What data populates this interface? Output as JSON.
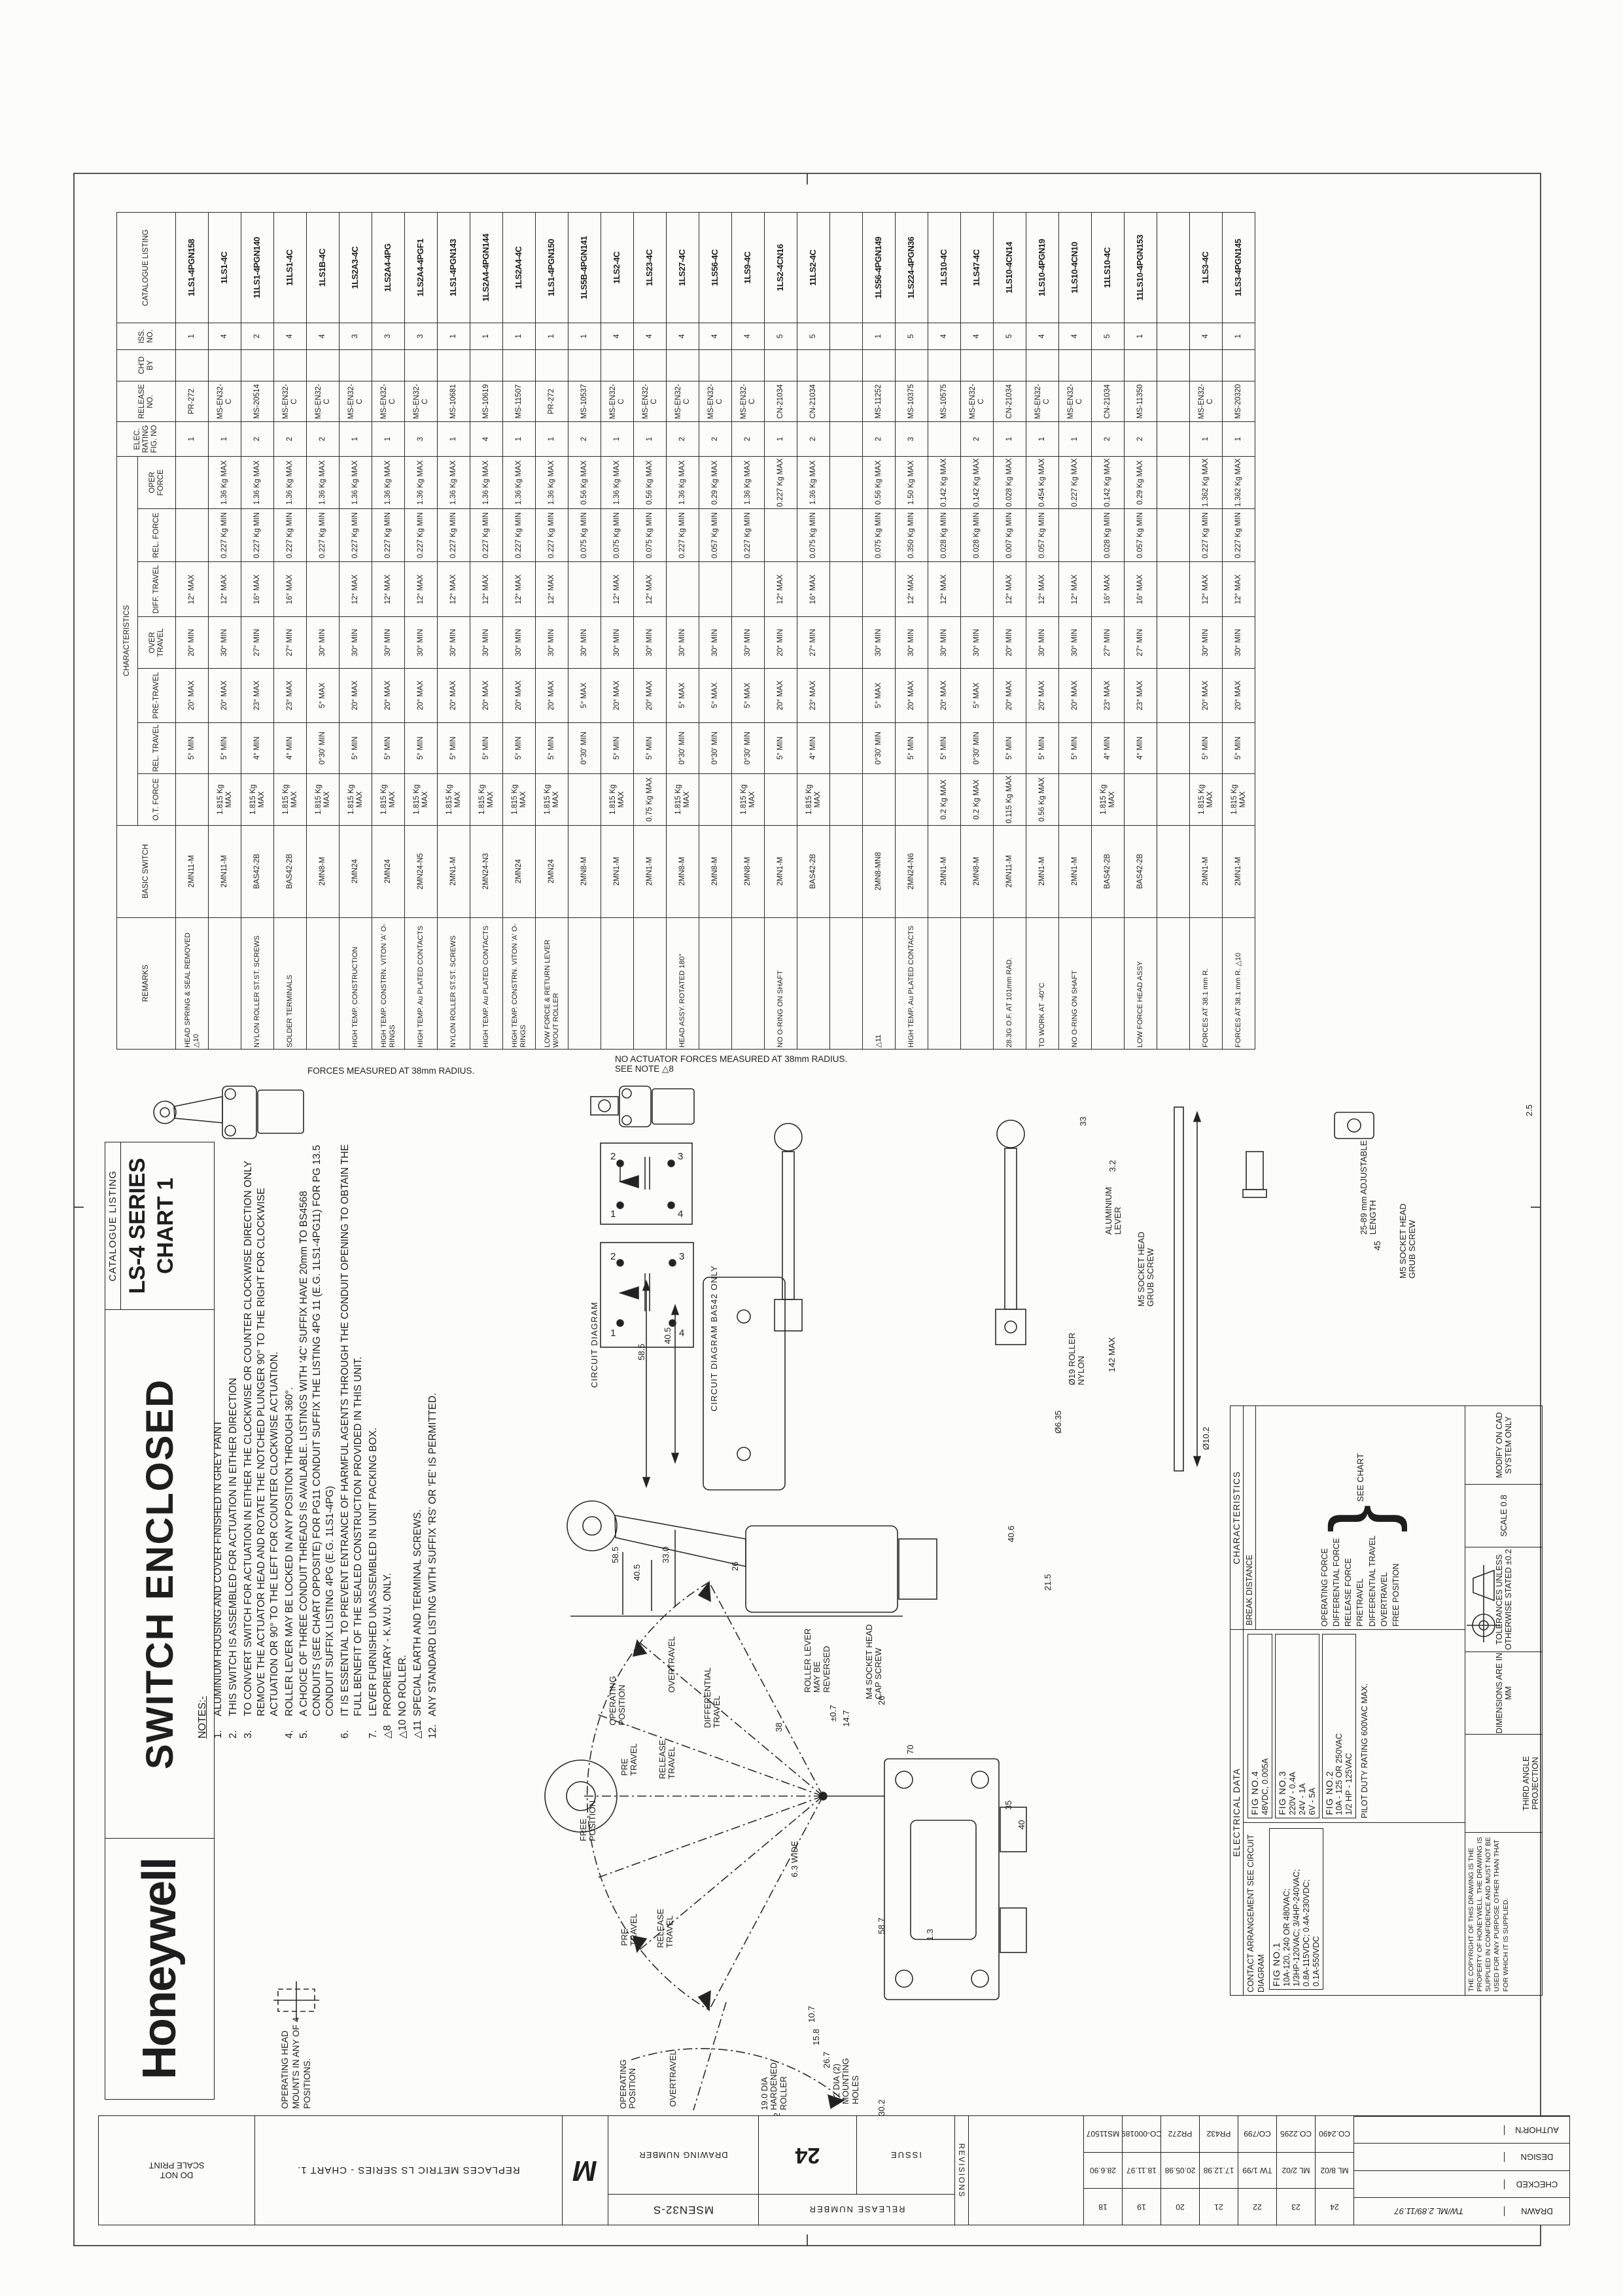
{
  "titleblock": {
    "brand": "Honeywell",
    "product": "SWITCH ENCLOSED",
    "listing_label": "CATALOGUE LISTING",
    "series": "LS-4 SERIES",
    "chart": "CHART 1",
    "head_note": "OPERATING HEAD MOUNTS IN ANY OF 4 POSITIONS."
  },
  "table": {
    "group": "CHARACTERISTICS",
    "headers": {
      "remarks": "REMARKS",
      "basic": "BASIC SWITCH",
      "otf": "O.T. FORCE",
      "relt": "REL. TRAVEL",
      "pre": "PRE-TRAVEL",
      "over": "OVER TRAVEL",
      "diff": "DIFF. TRAVEL",
      "relf": "REL. FORCE",
      "oper": "OPER FORCE",
      "elec": "ELEC. RATING FIG. NO",
      "release": "RELEASE NO.",
      "chd": "CH'D BY",
      "iss": "ISS. NO.",
      "cat": "CATALOGUE LISTING"
    },
    "rows": [
      {
        "rem": "HEAD SPRING & SEAL REMOVED △10",
        "basic": "2MN11-M",
        "otf": "",
        "relt": "5° MIN",
        "pre": "20° MAX",
        "over": "20° MIN",
        "diff": "12° MAX",
        "relf": "",
        "oper": "",
        "elec": "1",
        "rel": "PR-272",
        "chd": "",
        "iss": "1",
        "cat": "1LS1-4PGN158"
      },
      {
        "rem": "",
        "basic": "2MN11-M",
        "otf": "1.815 Kg MAX",
        "relt": "5° MIN",
        "pre": "20° MAX",
        "over": "30° MIN",
        "diff": "12° MAX",
        "relf": "0.227 Kg MIN",
        "oper": "1.36 Kg MAX",
        "elec": "1",
        "rel": "MS-EN32-C",
        "chd": "",
        "iss": "4",
        "cat": "1LS1-4C"
      },
      {
        "rem": "NYLON ROLLER ST.ST. SCREWS",
        "basic": "BAS42-2B",
        "otf": "1.815 Kg MAX",
        "relt": "4° MIN",
        "pre": "23° MAX",
        "over": "27° MIN",
        "diff": "16° MAX",
        "relf": "0.227 Kg MIN",
        "oper": "1.36 Kg MAX",
        "elec": "2",
        "rel": "MS-20514",
        "chd": "",
        "iss": "2",
        "cat": "11LS1-4PGN140"
      },
      {
        "rem": "SOLDER TERMINALS",
        "basic": "BAS42-2B",
        "otf": "1.815 Kg MAX",
        "relt": "4° MIN",
        "pre": "23° MAX",
        "over": "27° MIN",
        "diff": "16° MAX",
        "relf": "0.227 Kg MIN",
        "oper": "1.36 Kg MAX",
        "elec": "2",
        "rel": "MS-EN32-C",
        "chd": "",
        "iss": "4",
        "cat": "11LS1-4C"
      },
      {
        "rem": "",
        "basic": "2MN8-M",
        "otf": "1.815 Kg MAX",
        "relt": "0°30' MIN",
        "pre": "5° MAX",
        "over": "30° MIN",
        "diff": "",
        "relf": "0.227 Kg MIN",
        "oper": "1.36 Kg MAX",
        "elec": "2",
        "rel": "MS-EN32-C",
        "chd": "",
        "iss": "4",
        "cat": "1LS1B-4C"
      },
      {
        "rem": "HIGH TEMP. CONSTRUCTION",
        "basic": "2MN24",
        "otf": "1.815 Kg MAX",
        "relt": "5° MIN",
        "pre": "20° MAX",
        "over": "30° MIN",
        "diff": "12° MAX",
        "relf": "0.227 Kg MIN",
        "oper": "1.36 Kg MAX",
        "elec": "1",
        "rel": "MS-EN32-C",
        "chd": "",
        "iss": "3",
        "cat": "1LS2A3-4C"
      },
      {
        "rem": "HIGH TEMP. CONSTRN. VITON 'A' O-RINGS",
        "basic": "2MN24",
        "otf": "1.815 Kg MAX",
        "relt": "5° MIN",
        "pre": "20° MAX",
        "over": "30° MIN",
        "diff": "12° MAX",
        "relf": "0.227 Kg MIN",
        "oper": "1.36 Kg MAX",
        "elec": "1",
        "rel": "MS-EN32-C",
        "chd": "",
        "iss": "3",
        "cat": "1LS2A4-4PG"
      },
      {
        "rem": "HIGH TEMP. Au PLATED CONTACTS",
        "basic": "2MN24-N5",
        "otf": "1.815 Kg MAX",
        "relt": "5° MIN",
        "pre": "20° MAX",
        "over": "30° MIN",
        "diff": "12° MAX",
        "relf": "0.227 Kg MIN",
        "oper": "1.36 Kg MAX",
        "elec": "3",
        "rel": "MS-EN32-C",
        "chd": "",
        "iss": "3",
        "cat": "1LS2A4-4PGF1"
      },
      {
        "rem": "NYLON ROLLER ST.ST. SCREWS",
        "basic": "2MN1-M",
        "otf": "1.815 Kg MAX",
        "relt": "5° MIN",
        "pre": "20° MAX",
        "over": "30° MIN",
        "diff": "12° MAX",
        "relf": "0.227 Kg MIN",
        "oper": "1.36 Kg MAX",
        "elec": "1",
        "rel": "MS-10681",
        "chd": "",
        "iss": "1",
        "cat": "1LS1-4PGN143"
      },
      {
        "rem": "HIGH TEMP. Au PLATED CONTACTS",
        "basic": "2MN24-N3",
        "otf": "1.815 Kg MAX",
        "relt": "5° MIN",
        "pre": "20° MAX",
        "over": "30° MIN",
        "diff": "12° MAX",
        "relf": "0.227 Kg MIN",
        "oper": "1.36 Kg MAX",
        "elec": "4",
        "rel": "MS-10619",
        "chd": "",
        "iss": "1",
        "cat": "1LS2A4-4PGN144"
      },
      {
        "rem": "HIGH TEMP. CONSTRN. VITON 'A' O-RINGS",
        "basic": "2MN24",
        "otf": "1.815 Kg MAX",
        "relt": "5° MIN",
        "pre": "20° MAX",
        "over": "30° MIN",
        "diff": "12° MAX",
        "relf": "0.227 Kg MIN",
        "oper": "1.36 Kg MAX",
        "elec": "1",
        "rel": "MS-11507",
        "chd": "",
        "iss": "1",
        "cat": "1LS2A4-4C"
      },
      {
        "rem": "LOW FORCE & RETURN LEVER W/OUT ROLLER",
        "basic": "2MN24",
        "otf": "1.815 Kg MAX",
        "relt": "5° MIN",
        "pre": "20° MAX",
        "over": "30° MIN",
        "diff": "12° MAX",
        "relf": "0.227 Kg MIN",
        "oper": "1.36 Kg MAX",
        "elec": "1",
        "rel": "PR-272",
        "chd": "",
        "iss": "1",
        "cat": "1LS1-4PGN150"
      },
      {
        "rem": "",
        "basic": "2MN8-M",
        "otf": "",
        "relt": "0°30' MIN",
        "pre": "5° MAX",
        "over": "30° MIN",
        "diff": "",
        "relf": "0.075 Kg MIN",
        "oper": "0.56 Kg MAX",
        "elec": "2",
        "rel": "MS-10537",
        "chd": "",
        "iss": "1",
        "cat": "1LS5B-4PGN141"
      },
      {
        "rem": "",
        "basic": "2MN1-M",
        "otf": "1.815 Kg MAX",
        "relt": "5° MIN",
        "pre": "20° MAX",
        "over": "30° MIN",
        "diff": "12° MAX",
        "relf": "0.075 Kg MIN",
        "oper": "1.36 Kg MAX",
        "elec": "1",
        "rel": "MS-EN32-C",
        "chd": "",
        "iss": "4",
        "cat": "1LS2-4C"
      },
      {
        "rem": "",
        "basic": "2MN1-M",
        "otf": "0.75 Kg MAX",
        "relt": "5° MIN",
        "pre": "20° MAX",
        "over": "30° MIN",
        "diff": "12° MAX",
        "relf": "0.075 Kg MIN",
        "oper": "0.56 Kg MAX",
        "elec": "1",
        "rel": "MS-EN32-C",
        "chd": "",
        "iss": "4",
        "cat": "1LS23-4C"
      },
      {
        "rem": "HEAD ASSY. ROTATED 180°",
        "basic": "2MN8-M",
        "otf": "1.815 Kg MAX",
        "relt": "0°30' MIN",
        "pre": "5° MAX",
        "over": "30° MIN",
        "diff": "",
        "relf": "0.227 Kg MIN",
        "oper": "1.36 Kg MAX",
        "elec": "2",
        "rel": "MS-EN32-C",
        "chd": "",
        "iss": "4",
        "cat": "1LS27-4C"
      },
      {
        "rem": "",
        "basic": "2MN8-M",
        "otf": "",
        "relt": "0°30' MIN",
        "pre": "5° MAX",
        "over": "30° MIN",
        "diff": "",
        "relf": "0.057 Kg MIN",
        "oper": "0.29 Kg MAX",
        "elec": "2",
        "rel": "MS-EN32-C",
        "chd": "",
        "iss": "4",
        "cat": "1LS56-4C"
      },
      {
        "rem": "",
        "basic": "2MN8-M",
        "otf": "1.815 Kg MAX",
        "relt": "0°30' MIN",
        "pre": "5° MAX",
        "over": "30° MIN",
        "diff": "",
        "relf": "0.227 Kg MIN",
        "oper": "1.36 Kg MAX",
        "elec": "2",
        "rel": "MS-EN32-C",
        "chd": "",
        "iss": "4",
        "cat": "1LS9-4C"
      },
      {
        "rem": "NO O-RING ON SHAFT",
        "basic": "2MN1-M",
        "otf": "",
        "relt": "5° MIN",
        "pre": "20° MAX",
        "over": "20° MIN",
        "diff": "12° MAX",
        "relf": "",
        "oper": "0.227 Kg MAX",
        "elec": "1",
        "rel": "CN-21034",
        "chd": "",
        "iss": "5",
        "cat": "1LS2-4CN16"
      },
      {
        "rem": "",
        "basic": "BAS42-2B",
        "otf": "1.815 Kg MAX",
        "relt": "4° MIN",
        "pre": "23° MAX",
        "over": "27° MIN",
        "diff": "16° MAX",
        "relf": "0.075 Kg MIN",
        "oper": "1.36 Kg MAX",
        "elec": "2",
        "rel": "CN-21034",
        "chd": "",
        "iss": "5",
        "cat": "11LS2-4C"
      },
      {
        "rem": "",
        "basic": "",
        "otf": "",
        "relt": "",
        "pre": "",
        "over": "",
        "diff": "",
        "relf": "",
        "oper": "",
        "elec": "",
        "rel": "",
        "chd": "",
        "iss": "",
        "cat": ""
      },
      {
        "rem": "△11",
        "basic": "2MN8-MN8",
        "otf": "",
        "relt": "0°30' MIN",
        "pre": "5° MAX",
        "over": "30° MIN",
        "diff": "",
        "relf": "0.075 Kg MIN",
        "oper": "0.56 Kg MAX",
        "elec": "2",
        "rel": "MS-11252",
        "chd": "",
        "iss": "1",
        "cat": "1LS56-4PGN149"
      },
      {
        "rem": "HIGH TEMP. Au PLATED CONTACTS",
        "basic": "2MN24-N6",
        "otf": "",
        "relt": "5° MIN",
        "pre": "20° MAX",
        "over": "30° MIN",
        "diff": "12° MAX",
        "relf": "0.350 Kg MIN",
        "oper": "1.50 Kg MAX",
        "elec": "3",
        "rel": "MS-10375",
        "chd": "",
        "iss": "5",
        "cat": "1LS224-4PGN36"
      },
      {
        "rem": "",
        "basic": "2MN1-M",
        "otf": "0.2 Kg MAX",
        "relt": "5° MIN",
        "pre": "20° MAX",
        "over": "30° MIN",
        "diff": "12° MAX",
        "relf": "0.028 Kg MIN",
        "oper": "0.142 Kg MAX",
        "elec": "",
        "rel": "MS-10575",
        "chd": "",
        "iss": "4",
        "cat": "1LS10-4C"
      },
      {
        "rem": "",
        "basic": "2MN8-M",
        "otf": "0.2 Kg MAX",
        "relt": "0°30' MIN",
        "pre": "5° MAX",
        "over": "30° MIN",
        "diff": "",
        "relf": "0.028 Kg MIN",
        "oper": "0.142 Kg MAX",
        "elec": "2",
        "rel": "MS-EN32-C",
        "chd": "",
        "iss": "4",
        "cat": "1LS47-4C"
      },
      {
        "rem": "28.3G O.F. AT 101mm RAD.",
        "basic": "2MN11-M",
        "otf": "0.115 Kg MAX",
        "relt": "5° MIN",
        "pre": "20° MAX",
        "over": "20° MIN",
        "diff": "12° MAX",
        "relf": "0.007 Kg MIN",
        "oper": "0.028 Kg MAX",
        "elec": "1",
        "rel": "CN-21034",
        "chd": "",
        "iss": "5",
        "cat": "1LS10-4CN14"
      },
      {
        "rem": "TO WORK AT -40°C",
        "basic": "2MN1-M",
        "otf": "0.56 Kg MAX",
        "relt": "5° MIN",
        "pre": "20° MAX",
        "over": "30° MIN",
        "diff": "12° MAX",
        "relf": "0.057 Kg MIN",
        "oper": "0.454 Kg MAX",
        "elec": "1",
        "rel": "MS-EN32-C",
        "chd": "",
        "iss": "4",
        "cat": "1LS10-4PGN19"
      },
      {
        "rem": "NO O-RING ON SHAFT",
        "basic": "2MN1-M",
        "otf": "",
        "relt": "5° MIN",
        "pre": "20° MAX",
        "over": "30° MIN",
        "diff": "12° MAX",
        "relf": "",
        "oper": "0.227 Kg MAX",
        "elec": "1",
        "rel": "MS-EN32-C",
        "chd": "",
        "iss": "4",
        "cat": "1LS10-4CN10"
      },
      {
        "rem": "",
        "basic": "BAS42-2B",
        "otf": "1.815 Kg MAX",
        "relt": "4° MIN",
        "pre": "23° MAX",
        "over": "27° MIN",
        "diff": "16° MAX",
        "relf": "0.028 Kg MIN",
        "oper": "0.142 Kg MAX",
        "elec": "2",
        "rel": "CN-21034",
        "chd": "",
        "iss": "5",
        "cat": "11LS10-4C"
      },
      {
        "rem": "LOW FORCE HEAD ASSY",
        "basic": "BAS42-2B",
        "otf": "",
        "relt": "4° MIN",
        "pre": "23° MAX",
        "over": "27° MIN",
        "diff": "16° MAX",
        "relf": "0.057 Kg MIN",
        "oper": "0.29 Kg MAX",
        "elec": "2",
        "rel": "MS-11350",
        "chd": "",
        "iss": "1",
        "cat": "11LS10-4PGN153"
      },
      {
        "rem": "",
        "basic": "",
        "otf": "",
        "relt": "",
        "pre": "",
        "over": "",
        "diff": "",
        "relf": "",
        "oper": "",
        "elec": "",
        "rel": "",
        "chd": "",
        "iss": "",
        "cat": ""
      },
      {
        "rem": "FORCES AT 38.1 mm R.",
        "basic": "2MN1-M",
        "otf": "1.815 Kg MAX",
        "relt": "5° MIN",
        "pre": "20° MAX",
        "over": "30° MIN",
        "diff": "12° MAX",
        "relf": "0.227 Kg MIN",
        "oper": "1.362 Kg MAX",
        "elec": "1",
        "rel": "MS-EN32-C",
        "chd": "",
        "iss": "4",
        "cat": "1LS3-4C"
      },
      {
        "rem": "FORCES AT 38.1 mm R. △10",
        "basic": "2MN1-M",
        "otf": "1.815 Kg MAX",
        "relt": "5° MIN",
        "pre": "20° MAX",
        "over": "30° MIN",
        "diff": "12° MAX",
        "relf": "0.227 Kg MIN",
        "oper": "1.362 Kg MAX",
        "elec": "1",
        "rel": "MS-20320",
        "chd": "",
        "iss": "1",
        "cat": "1LS3-4PGN145"
      }
    ],
    "forces_note": "FORCES MEASURED AT 38mm RADIUS.",
    "no_actuator_note": "NO ACTUATOR FORCES MEASURED AT 38mm RADIUS.",
    "see_note": "SEE NOTE △8"
  },
  "notes": {
    "title": "NOTES:-",
    "items": [
      {
        "no": "1.",
        "text": "ALUMINIUM HOUSING AND COVER FINISHED IN GREY PAINT"
      },
      {
        "no": "2.",
        "text": "THIS SWITCH IS ASSEMBLED FOR ACTUATION IN EITHER DIRECTION"
      },
      {
        "no": "3.",
        "text": "TO CONVERT SWITCH FOR ACTUATION IN EITHER THE CLOCKWISE OR COUNTER CLOCKWISE DIRECTION ONLY REMOVE THE ACTUATOR HEAD AND ROTATE THE NOTCHED PLUNGER 90° TO THE RIGHT FOR CLOCKWISE ACTUATION OR 90° TO THE LEFT FOR COUNTER CLOCKWISE ACTUATION."
      },
      {
        "no": "4.",
        "text": "ROLLER LEVER MAY BE LOCKED IN ANY POSITION THROUGH 360°."
      },
      {
        "no": "5.",
        "text": "A CHOICE OF THREE CONDUIT THREADS IS AVAILABLE. LISTINGS WITH '4C' SUFFIX HAVE 20mm TO BS4568 CONDUITS (SEE CHART OPPOSITE) FOR PG11 CONDUIT SUFFIX THE LISTING 4PG 11 (E.G. 1LS1-4PG11) FOR PG 13.5 CONDUIT SUFFIX LISTING 4PG (E.G. 1LS1-4PG)"
      },
      {
        "no": "6.",
        "text": "IT IS ESSENTIAL TO PREVENT ENTRANCE OF HARMFUL AGENTS THROUGH THE CONDUIT OPENING TO OBTAIN THE FULL BENEFIT OF THE SEALED CONSTRUCTION PROVIDED IN THIS UNIT."
      },
      {
        "no": "7.",
        "text": "LEVER FURNISHED UNASSEMBLED IN UNIT PACKING BOX."
      },
      {
        "no": "△8",
        "text": "PROPRIETARY - K.W.U. ONLY."
      },
      {
        "no": "△10",
        "text": "NO ROLLER."
      },
      {
        "no": "△11",
        "text": "SPECIAL EARTH AND TERMINAL SCREWS."
      },
      {
        "no": "12.",
        "text": "ANY STANDARD LISTING WITH SUFFIX 'RS' OR 'FE' IS PERMITTED."
      }
    ]
  },
  "circuit": {
    "label_main": "CIRCUIT DIAGRAM",
    "label_ba542": "CIRCUIT DIAGRAM BA542 ONLY",
    "terminals": [
      "1",
      "2",
      "3",
      "4"
    ]
  },
  "info": {
    "electrical_title": "ELECTRICAL DATA",
    "contact": "CONTACT ARRANGEMENT SEE CIRCUIT DIAGRAM",
    "fig1": {
      "title": "FIG NO.1",
      "lines": [
        "10A-120, 240 OR 480VAC;",
        "1/3HP-120VAC; 3/4HP-240VAC;",
        "0.8A-115VDC; 0.4A-230VDC;",
        "0.1A-550VDC"
      ]
    },
    "fig4": {
      "title": "FIG NO.4",
      "lines": [
        "48VDC, 0.005A"
      ]
    },
    "fig3": {
      "title": "FIG NO.3",
      "lines": [
        "220V - 0.4A",
        "24V - 1A",
        "6V - 5A"
      ]
    },
    "fig2": {
      "title": "FIG NO.2",
      "lines": [
        "10A - 125 OR 250VAC",
        "1/2 HP - 125VAC"
      ]
    },
    "pilot": "PILOT DUTY RATING 600VAC MAX.",
    "characteristics_title": "CHARACTERISTICS",
    "break_distance": "BREAK DISTANCE",
    "char_items": [
      "OPERATING FORCE",
      "DIFFERENTIAL FORCE",
      "RELEASE FORCE",
      "PRETRAVEL",
      "DIFFERENTIAL TRAVEL",
      "OVERTRAVEL",
      "FREE POSITION"
    ],
    "see_chart": "SEE CHART",
    "proprietary": "THE COPYRIGHT OF THIS DRAWING IS THE PROPERTY OF HONEYWELL. THE DRAWING IS SUPPLIED IN CONFIDENCE AND MUST NOT BE USED FOR ANY PURPOSE OTHER THAN THAT FOR WHICH IT IS SUPPLIED.",
    "third_angle": "THIRD ANGLE PROJECTION",
    "dims_mm": "DIMENSIONS ARE IN MM",
    "tolerances": "TOLERANCES UNLESS OTHERWISE STATED ±0.2",
    "scale": "SCALE 0.8",
    "modify": "MODIFY ON CAD SYSTEM ONLY"
  },
  "margin": {
    "do_not": "DO NOT",
    "scale_print": "SCALE PRINT",
    "replaces": "REPLACES METRIC LS SERIES - CHART 1.",
    "metric_symbol": "M",
    "drawing_number_label": "DRAWING NUMBER",
    "drawing_number": "MSEN32-S",
    "release_label": "RELEASE NUMBER",
    "issue_label": "ISSUE",
    "issue": "24",
    "revisions_label": "REVISIONS",
    "revisions": [
      {
        "no": "24",
        "date": "ML 8/02",
        "ref": "CO.2490"
      },
      {
        "no": "23",
        "date": "ML 2/02",
        "ref": "CO.2295"
      },
      {
        "no": "22",
        "date": "TW 1/99",
        "ref": "CO/799"
      },
      {
        "no": "21",
        "date": "17.12.98",
        "ref": "PR432"
      },
      {
        "no": "20",
        "date": "20.05.98",
        "ref": "PR272"
      },
      {
        "no": "19",
        "date": "18.11.97",
        "ref": "CO-000189"
      },
      {
        "no": "18",
        "date": "28.6.90",
        "ref": "MS11507"
      }
    ],
    "signoff": [
      {
        "label": "DRAWN",
        "value": "TW/ML   2.89/11.97"
      },
      {
        "label": "CHECKED",
        "value": ""
      },
      {
        "label": "DESIGN",
        "value": ""
      },
      {
        "label": "AUTHOR'N",
        "value": ""
      }
    ]
  },
  "drawing": {
    "free_pos": "FREE POSITION",
    "pre_travel": "PRE TRAVEL",
    "release_travel": "RELEASE TRAVEL",
    "oper_pos": "OPERATING POSITION",
    "overtravel": "OVERTRAVEL",
    "diff_travel": "DIFFERENTIAL TRAVEL",
    "roller_rev": "ROLLER LEVER MAY BE REVERSED",
    "m4": "M4 SOCKET HEAD CAP SCREW",
    "hardened": "19.0 DIA HARDENED ROLLER",
    "mount_holes": "5.2 DIA (2) MOUNTING HOLES",
    "wide": "6.3 WIDE",
    "alu": "ALUMINIUM LEVER",
    "m5": "M5 SOCKET HEAD GRUB SCREW",
    "adj": "25-89 mm ADJUSTABLE LENGTH",
    "nylon": "Ø19 ROLLER NYLON",
    "d142": "142 MAX",
    "d635": "Ø6.35",
    "d102": "Ø10.2",
    "d25": "2.5",
    "d45": "45",
    "d33": "33",
    "d32": "3.2",
    "d585": "58.5",
    "d405": "40.5",
    "d330": "33.0",
    "d26": "26",
    "d38": "38",
    "d07": "±0.7",
    "d147": "14.7",
    "d70": "70",
    "d215": "21.5",
    "d35": "35",
    "d40": "40",
    "d302": "30.2",
    "d158": "15.8",
    "d267": "26.7",
    "d107": "10.7",
    "d52": "5.2",
    "d587": "58.7",
    "d13": "1.3",
    "d406": "40.6"
  }
}
